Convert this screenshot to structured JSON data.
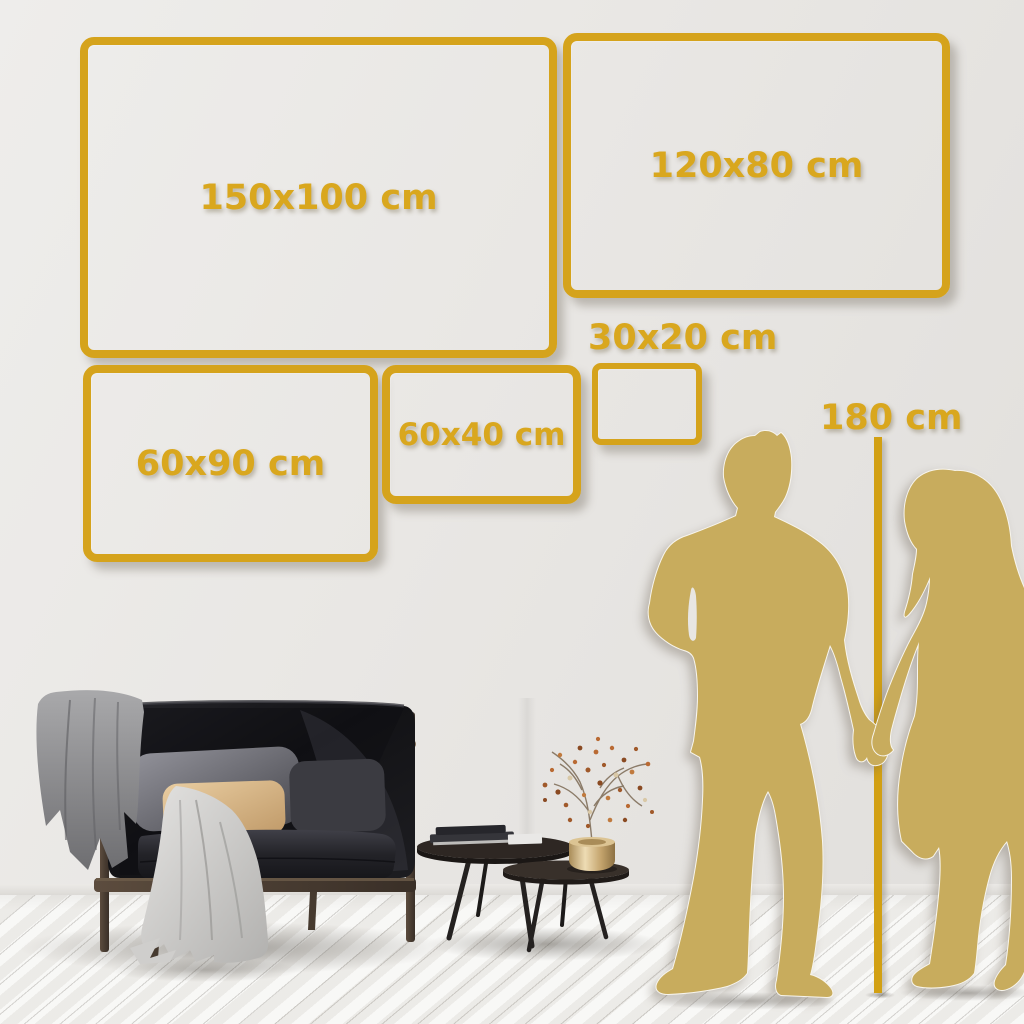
{
  "image_type": "wall-art-size-guide",
  "labels": {
    "sizes": [
      {
        "id": "150x100",
        "label": "150x100 cm"
      },
      {
        "id": "120x80",
        "label": "120x80 cm"
      },
      {
        "id": "30x20",
        "label": "30x20 cm"
      },
      {
        "id": "60x40",
        "label": "60x40 cm"
      },
      {
        "id": "60x90",
        "label": "60x90 cm"
      }
    ],
    "height_reference": {
      "label": "180 cm"
    }
  },
  "colors": {
    "accent_gold": "#d5a31c",
    "label_gold": "#d9a71e",
    "silhouette_gold": "#c8ac5d",
    "wall": "#e9e7e4",
    "floor": "#f3f2ef"
  },
  "scene": {
    "furniture": [
      "dark velvet sofa with wood frame",
      "gray blanket on armrest",
      "beige pillow",
      "gray pillow",
      "white draped throw",
      "two nesting coffee tables",
      "stacked books",
      "brass vase with dried berry branch"
    ],
    "figures": [
      "man silhouette",
      "woman silhouette",
      "couple holding hands",
      "vertical height measure line"
    ]
  }
}
